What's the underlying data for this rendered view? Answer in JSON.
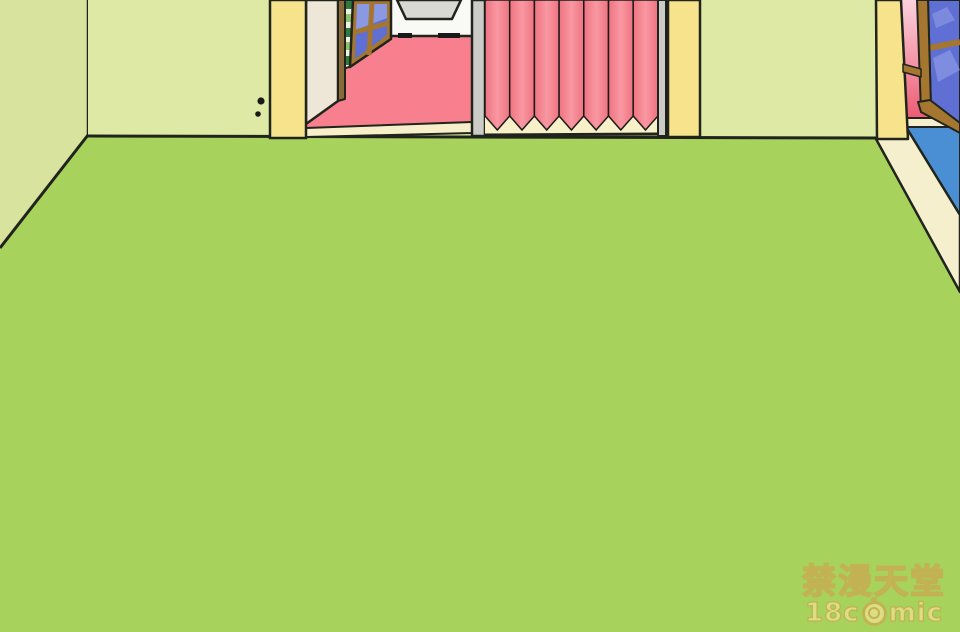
{
  "colors": {
    "wall_green": "#dde9a5",
    "wall_green_side": "#d8e49e",
    "floor_green": "#a7d35c",
    "pillar_yellow": "#f7e38b",
    "outline": "#20241c",
    "door_cream": "#eee7d7",
    "door_edge_brown": "#8a6a38",
    "inner_wall_white": "#f9f9f6",
    "wall_object_grey": "#d9d9d4",
    "inner_floor_pink": "#f87f8d",
    "threshold_cream": "#f6efca",
    "stripe_dark": "#2f7a3e",
    "stripe_light": "#8cc46a",
    "stripe_white": "#f1f1e8",
    "window_brown": "#a5762f",
    "pane_blue": "#5f6fd3",
    "pane_blue_light": "#93a1e8",
    "grey_post": "#cbcbc7",
    "curtain_dark": "#ee7380",
    "curtain_light": "#f998a2",
    "curtain_backing": "#f7f0c8",
    "right_wall_pink_top": "#fbd3dd",
    "right_wall_pink_mid": "#f491a5",
    "right_wall_pink_bottom": "#ec5a72",
    "right_floor_blue": "#4a8fd4",
    "baseboard_cream": "#f6efcd",
    "black_mark": "#1a1a1a"
  },
  "css_vars": {
    "watermark-fill": "#e9e08d",
    "watermark-stroke": "#c8ab53"
  },
  "watermark": {
    "line1": "禁漫天堂",
    "line2_prefix": "18c",
    "line2_suffix": "mic"
  },
  "icons": {
    "watermark_o": "monkey-face-icon"
  }
}
